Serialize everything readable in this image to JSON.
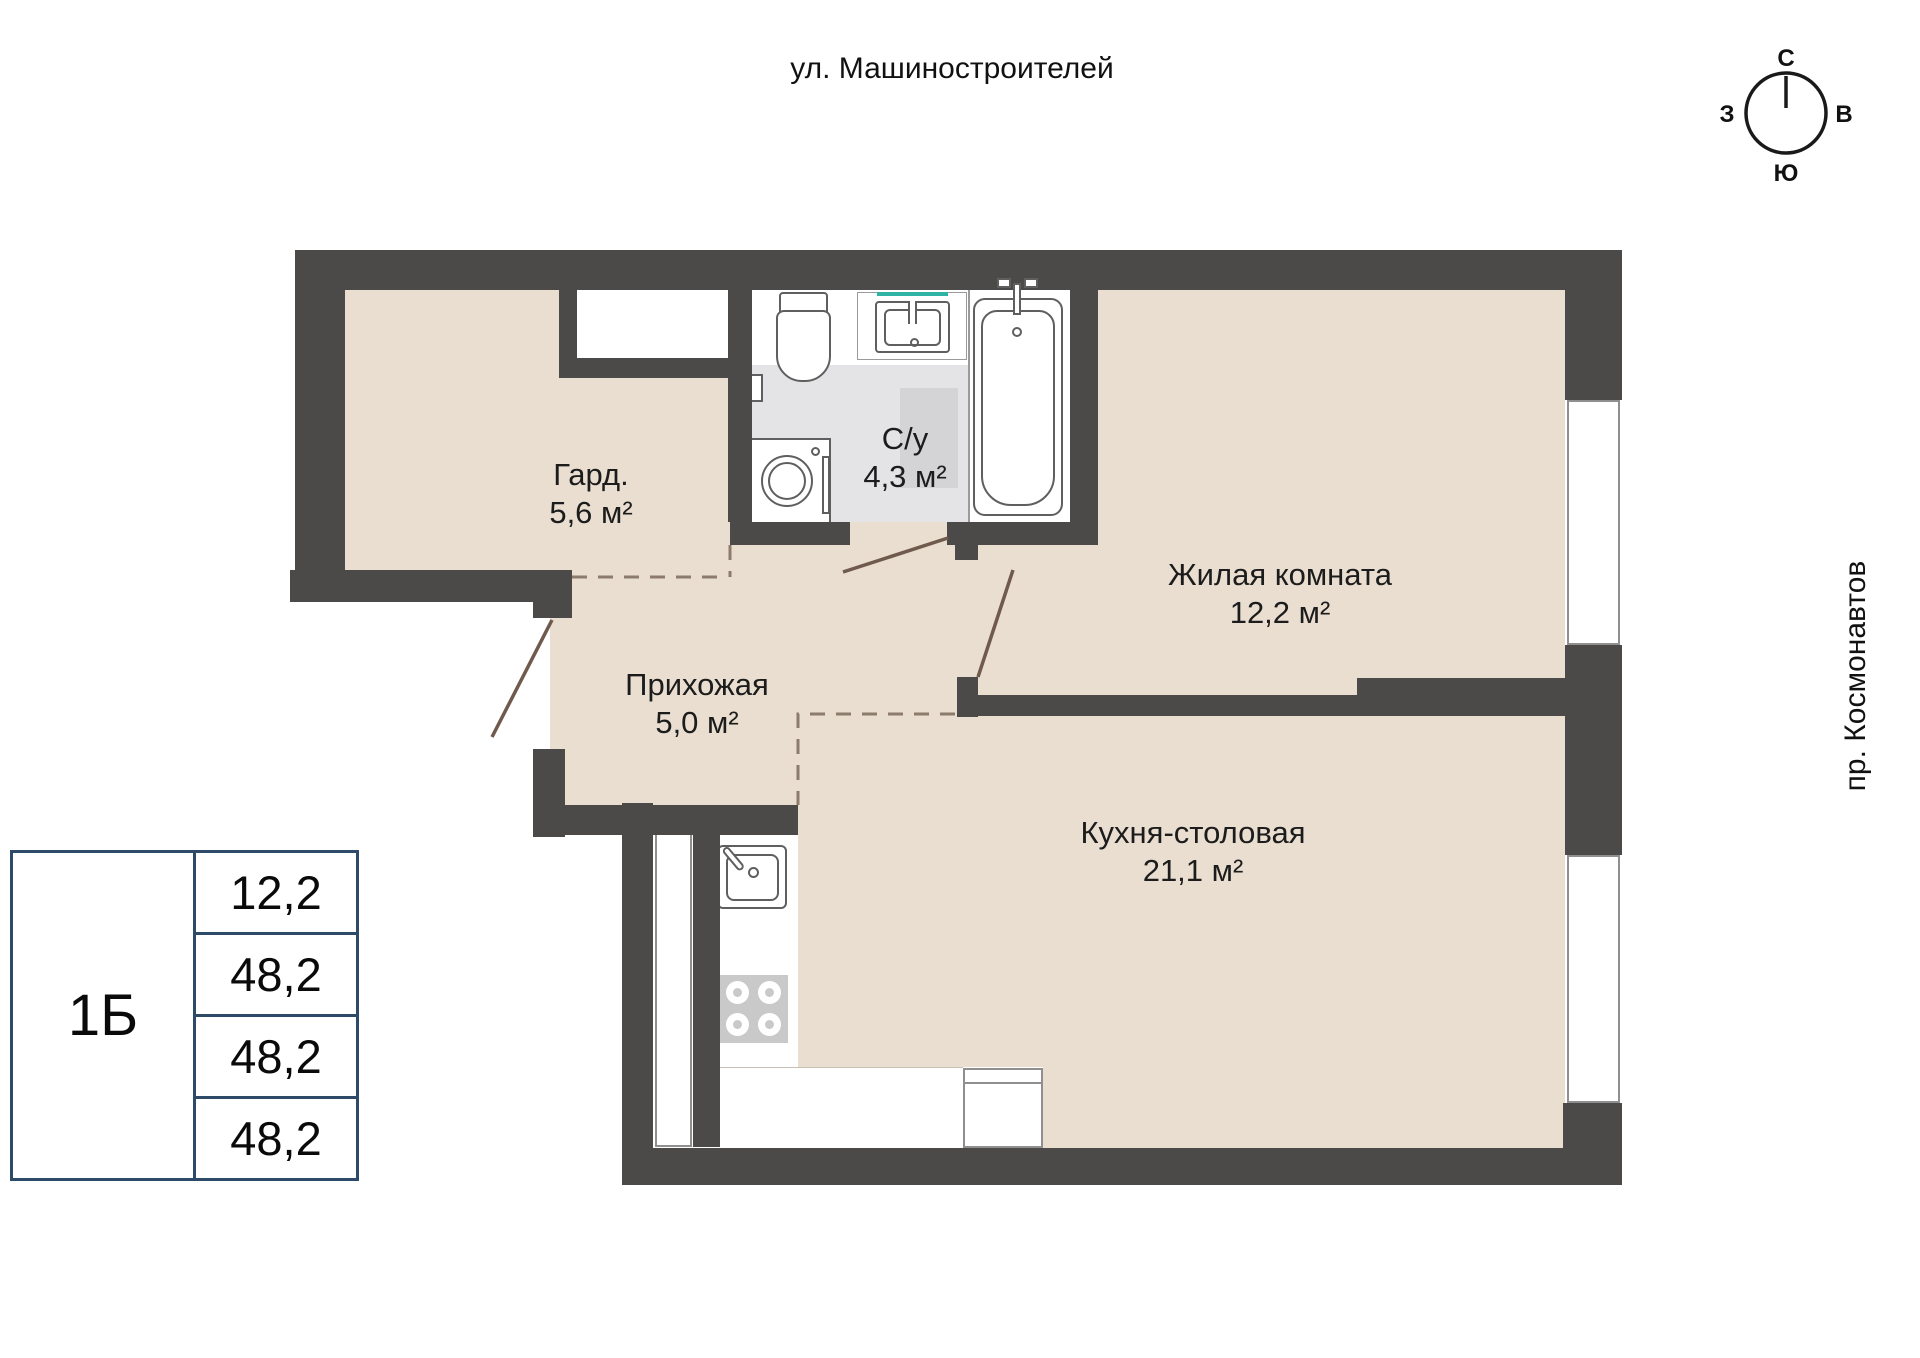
{
  "header": {
    "street_top": "ул. Машиностроителей",
    "street_right": "пр. Космонавтов"
  },
  "compass": {
    "north": "С",
    "south": "Ю",
    "west": "З",
    "east": "В"
  },
  "rooms": [
    {
      "name": "Гард.",
      "area": "5,6 м²"
    },
    {
      "name": "С/у",
      "area": "4,3 м²"
    },
    {
      "name": "Жилая комната",
      "area": "12,2 м²"
    },
    {
      "name": "Прихожая",
      "area": "5,0 м²"
    },
    {
      "name": "Кухня-столовая",
      "area": "21,1 м²"
    }
  ],
  "info_table": {
    "unit": "1Б",
    "values": [
      "12,2",
      "48,2",
      "48,2",
      "48,2"
    ]
  },
  "colors": {
    "wall": "#4c4a48",
    "floor": "#e9ded0",
    "bath_floor": "#e4e4e6",
    "bath_floor_dark": "#d4d4d6",
    "accent_teal": "#2fb3a4",
    "table_border": "#2d4b69",
    "dash": "#8d7c6d",
    "door": "#6f5a4d"
  }
}
